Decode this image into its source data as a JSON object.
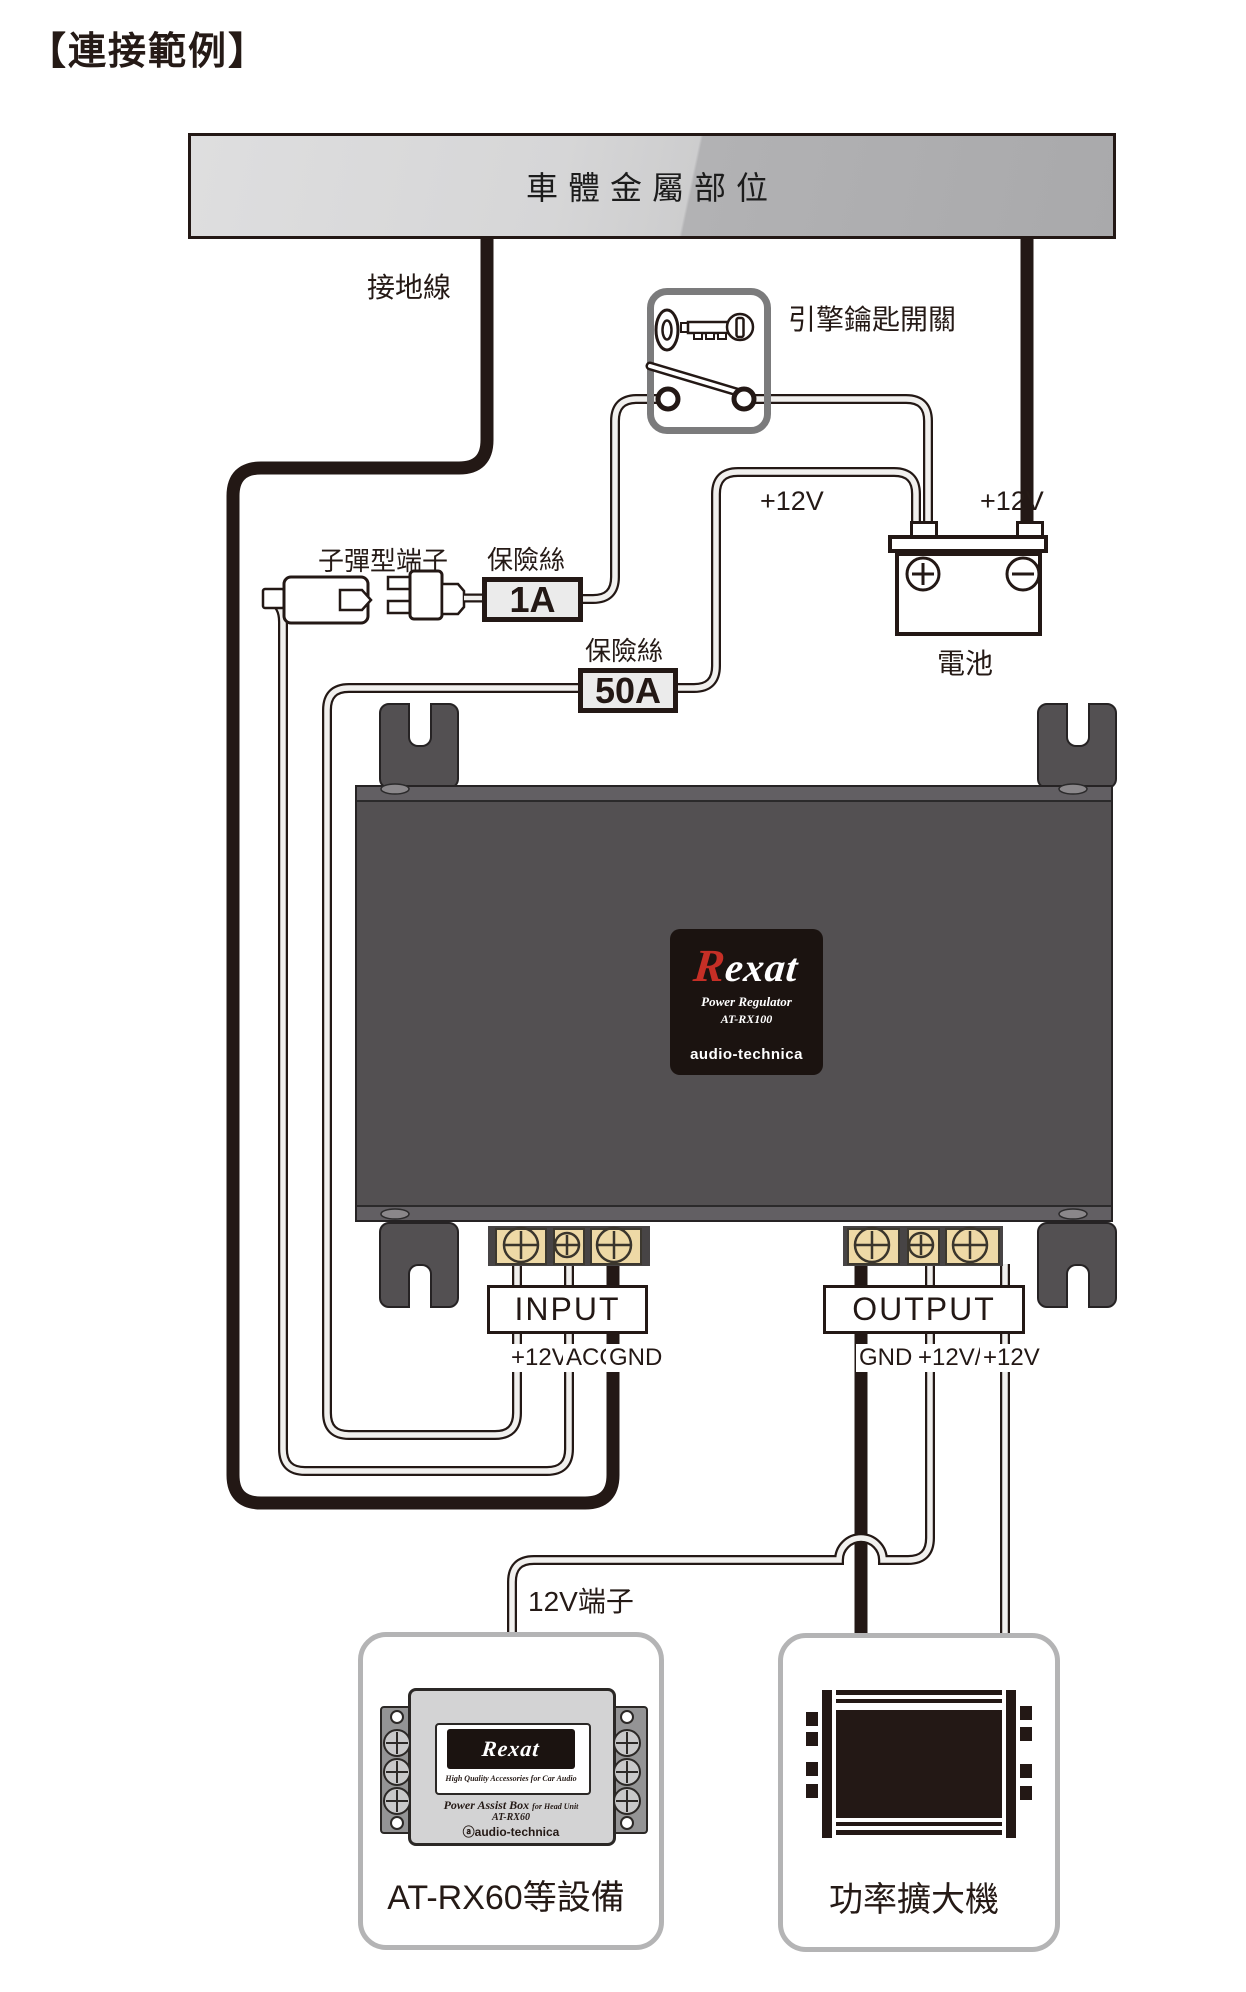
{
  "title": "【連接範例】",
  "car_body": {
    "label": "車體金屬部位"
  },
  "wiring": {
    "ground_label": "接地線",
    "ignition_label": "引擎鑰匙開關",
    "bullet_terminal_label": "子彈型端子",
    "fuse_small": {
      "label": "保險絲",
      "value": "1A"
    },
    "fuse_large": {
      "label": "保險絲",
      "value": "50A"
    },
    "v12_switch_side": "+12V",
    "v12_battery_side": "+12V",
    "battery_label": "電池",
    "terminal_12v_label": "12V端子"
  },
  "regulator": {
    "logo_r": "R",
    "logo_rest": "exat",
    "subtitle": "Power Regulator",
    "model": "AT-RX100",
    "brand": "audio-technica"
  },
  "input": {
    "label": "INPUT",
    "terminals": [
      "+12V",
      "ACC",
      "GND"
    ]
  },
  "output": {
    "label": "OUTPUT",
    "terminals": [
      "GND",
      "+12V/S",
      "+12V"
    ]
  },
  "devices": {
    "head_unit": {
      "logo": "Rexat",
      "tagline": "High Quality Accessories for Car Audio",
      "product": "Power Assist Box",
      "product_note": "for Head Unit",
      "model": "AT-RX60",
      "brand": "ⓐaudio-technica",
      "caption": "AT-RX60等設備"
    },
    "amplifier": {
      "caption": "功率擴大機"
    }
  },
  "colors": {
    "accent_red": "#c62f26",
    "line_dark": "#231815",
    "unit_gray": "#535052",
    "terminal_tan": "#eed9a6"
  }
}
